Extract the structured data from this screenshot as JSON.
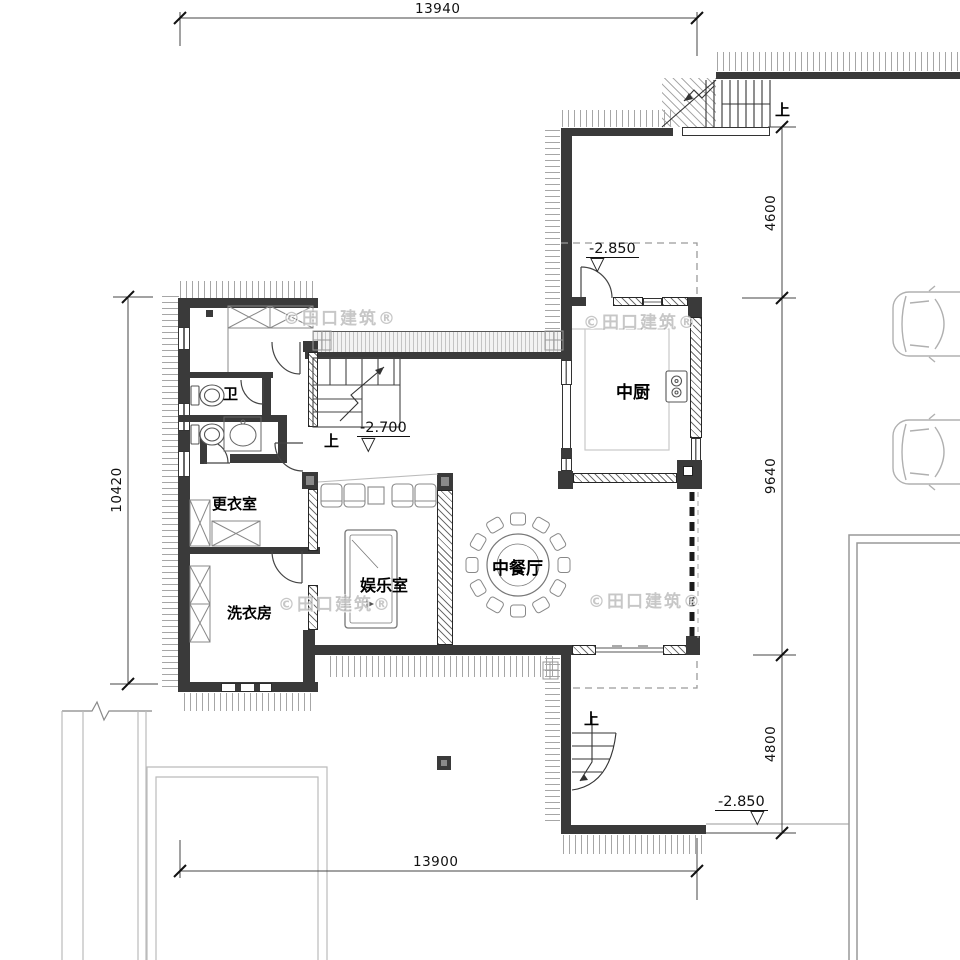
{
  "drawing": {
    "watermark": "©田口建筑®",
    "dimensions": {
      "top": "13940",
      "bottom": "13900",
      "left": "10420",
      "right_upper": "4600",
      "right_middle": "9640",
      "right_lower": "4800"
    },
    "elevations": {
      "kitchen_entry": "-2.850",
      "hall": "-2.700",
      "rear_terrace": "-2.850"
    },
    "rooms": {
      "kitchen": "中厨",
      "dining": "中餐厅",
      "entertainment": "娱乐室",
      "dressing": "更衣室",
      "laundry": "洗衣房",
      "wc": "卫"
    },
    "stair_up": "上",
    "symbols": {
      "elevation": "▽"
    }
  }
}
